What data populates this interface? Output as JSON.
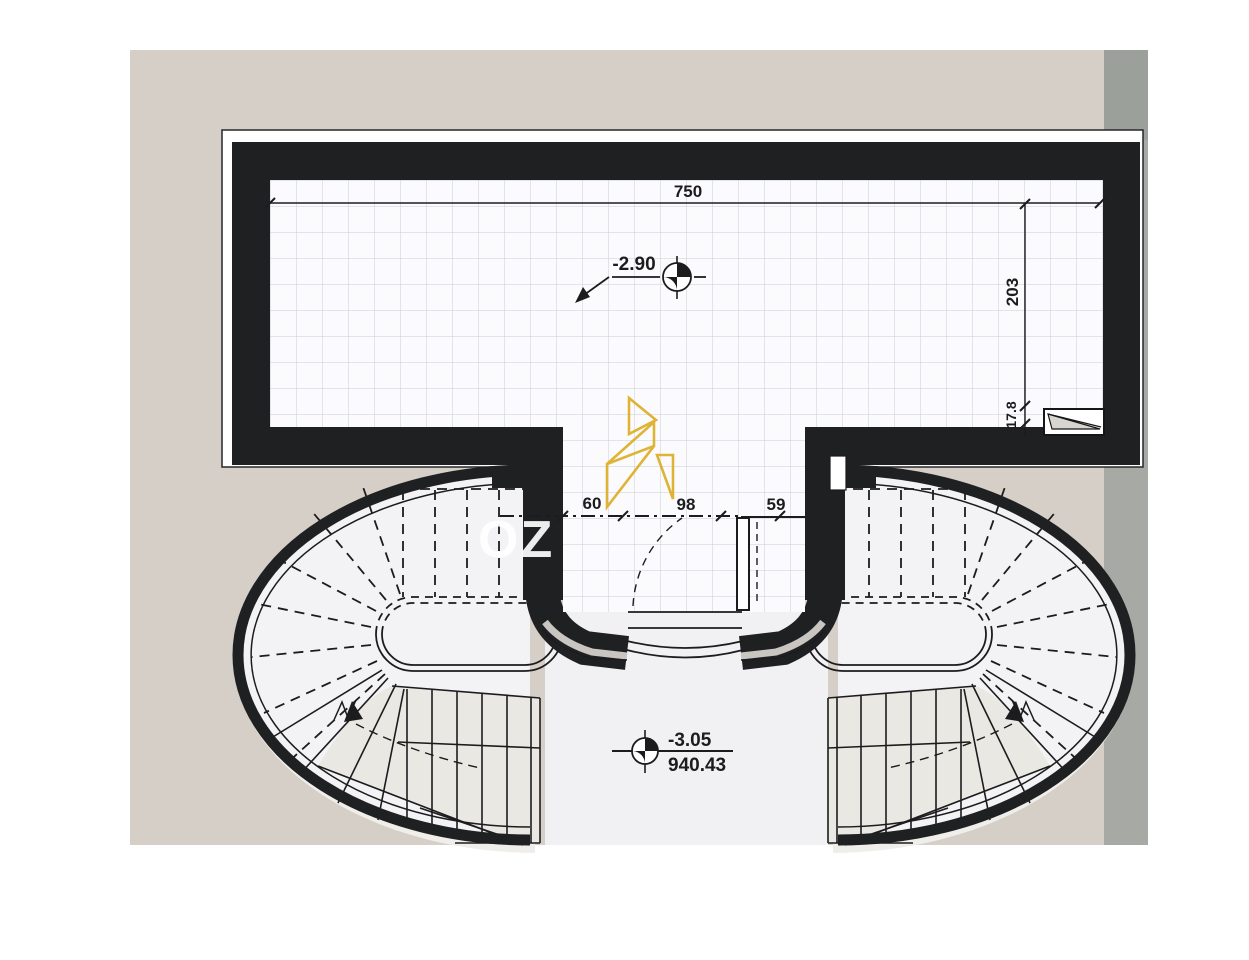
{
  "document": {
    "kind": "scanned architectural floor plan",
    "description": "Basement level plan: rectangular tiled room above, twin curved stairs below"
  },
  "colors": {
    "paper": "#d6cfc7",
    "scan_strip": "#a7aaa4",
    "scan_strip_dark": "#9ca09a",
    "wall": "#1f2022",
    "grid_line": "#c8ccd8",
    "floor": "#fbfbfd",
    "stair_floor": "#f3f2f4",
    "tread_band": "#eae8e3",
    "logo_gold": "#deb02c"
  },
  "dimensions": {
    "top_width": "750",
    "right_height": "203",
    "right_inset": "17.8",
    "opening_left": "60",
    "opening_mid": "98",
    "opening_right": "59"
  },
  "levels": {
    "upper_room_level": "-2.90",
    "stair_hall_level": "-3.05",
    "stair_hall_elevation": "940.43"
  },
  "watermark": {
    "text": "OZ",
    "logo": "gold-angular-logo"
  }
}
